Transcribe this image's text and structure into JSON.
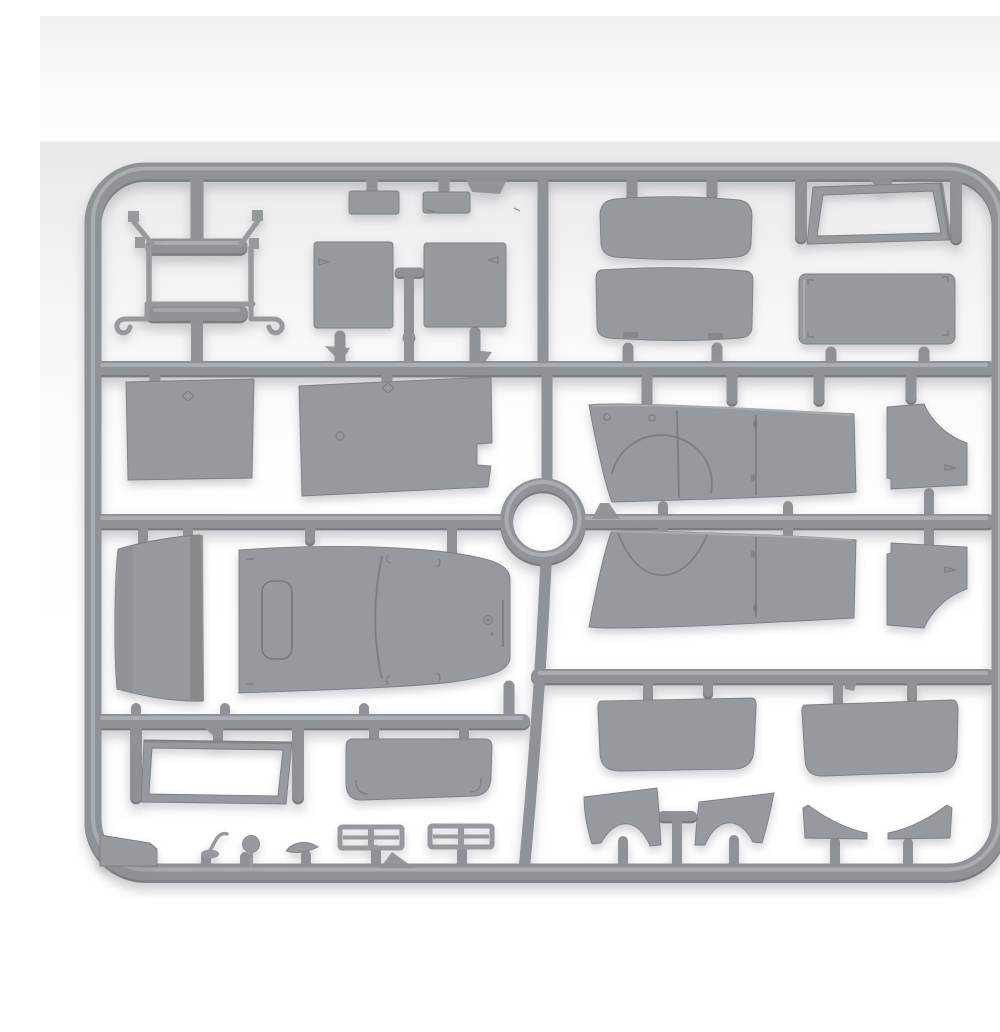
{
  "image": {
    "kind": "product-photo",
    "subject": "Injection-molded gray styrene model kit sprue with vehicle body parts",
    "alt": "Gray plastic model-kit sprue frame holding van body panels, seats, windshield frames, fenders and small parts, on a white studio background",
    "width": 1000,
    "height": 1000
  },
  "palette": {
    "pf": "#8f9296",
    "pd": "#7a7d81",
    "pl": "#aeb1b5",
    "part": "#96999d",
    "pedge": "#7c7f83",
    "pdet": "#75787c",
    "bgtop": "#fdfdfd",
    "bgband": "#e9e9ec",
    "bg": "#ffffff"
  },
  "sprue": {
    "material_color_name": "light gray styrene",
    "frame_shape": "rounded rectangle",
    "center_ring": true,
    "runner_rows": 3,
    "parts": [
      {
        "id": "brush-guard-frame",
        "name": "front guard / step frame with hooks"
      },
      {
        "id": "small-box-a",
        "name": "small rectangular block A"
      },
      {
        "id": "small-box-b",
        "name": "small rectangular block B"
      },
      {
        "id": "seat-back-left",
        "name": "seat backrest panel left"
      },
      {
        "id": "seat-back-right",
        "name": "seat backrest panel right"
      },
      {
        "id": "bench-cushion",
        "name": "bench seat cushion"
      },
      {
        "id": "bench-backrest",
        "name": "bench seat backrest"
      },
      {
        "id": "windshield-frame",
        "name": "windshield frame (open trapezoid)"
      },
      {
        "id": "door-panel",
        "name": "rectangular door/hatch panel with corner brackets"
      },
      {
        "id": "bulkhead-panel",
        "name": "square bulkhead panel"
      },
      {
        "id": "floor-panel",
        "name": "tapered floor panel with notch"
      },
      {
        "id": "body-side-upper",
        "name": "body side panel with wheel-arch (upper)"
      },
      {
        "id": "body-side-lower",
        "name": "body side panel with wheel-arch (mirrored)"
      },
      {
        "id": "fender-upper",
        "name": "cab corner fender (upper)"
      },
      {
        "id": "fender-lower",
        "name": "cab corner fender (mirrored)"
      },
      {
        "id": "cab-rear-panel",
        "name": "curved cab rear panel"
      },
      {
        "id": "cab-roof",
        "name": "cab roof with hatch and filler cap"
      },
      {
        "id": "window-frame",
        "name": "rectangular window frame"
      },
      {
        "id": "windscreen-panel",
        "name": "windscreen panel with bracket marks"
      },
      {
        "id": "corner-wedge",
        "name": "flat wedge strip at corner"
      },
      {
        "id": "gear-lever",
        "name": "gear lever"
      },
      {
        "id": "shift-knob",
        "name": "round knob"
      },
      {
        "id": "visor-strip",
        "name": "small curved visor strip"
      },
      {
        "id": "grille-slat-a",
        "name": "louver slat unit A"
      },
      {
        "id": "grille-slat-b",
        "name": "louver slat unit B"
      },
      {
        "id": "glass-panel-left",
        "name": "curved glazing panel left"
      },
      {
        "id": "glass-panel-right",
        "name": "curved glazing panel right"
      },
      {
        "id": "mudguard-left",
        "name": "curved mudguard left"
      },
      {
        "id": "mudguard-right",
        "name": "curved mudguard right"
      },
      {
        "id": "splash-wedge-left",
        "name": "splash guard wedge left"
      },
      {
        "id": "splash-wedge-right",
        "name": "splash guard wedge right"
      }
    ]
  }
}
